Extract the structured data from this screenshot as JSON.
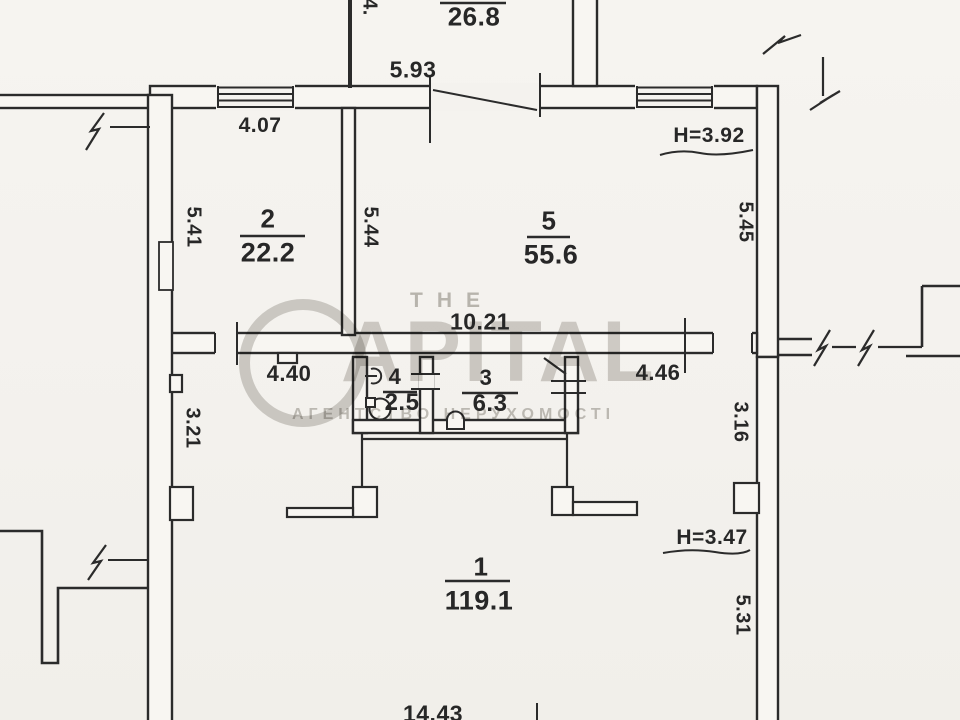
{
  "palette": {
    "paper": "#f4f2ee",
    "ink": "#2b2b2b",
    "watermark": "#8c8880"
  },
  "rooms": [
    {
      "number": "2",
      "area": "22.2"
    },
    {
      "number": "5",
      "area": "55.6"
    },
    {
      "number": "4",
      "area": "2.5"
    },
    {
      "number": "3",
      "area": "6.3"
    },
    {
      "number": "1",
      "area": "119.1"
    },
    {
      "number": "",
      "area": "26.8"
    }
  ],
  "dimensions": {
    "top_width": "5.93",
    "top_room_side": "4.",
    "room2_top": "4.07",
    "room2_left": "5.41",
    "divider_left": "5.44",
    "room5_right": "5.45",
    "ceiling_top": "H=3.92",
    "hall_width": "10.21",
    "hall_left_width": "4.40",
    "hall_right_width": "4.46",
    "left_lower": "3.21",
    "right_mid": "3.16",
    "ceiling_bottom": "H=3.47",
    "right_lower": "5.31",
    "bottom_width": "14.43"
  },
  "watermark": {
    "prefix": "THE",
    "brand_letters": "APITAL",
    "tagline": "АГЕНТСТВО НЕРУХОМОСТІ"
  },
  "icons": [
    "sink-icon",
    "washing-machine-icon",
    "toilet-icon",
    "window-icon",
    "door-leaf-icon",
    "wall-break-icon"
  ]
}
